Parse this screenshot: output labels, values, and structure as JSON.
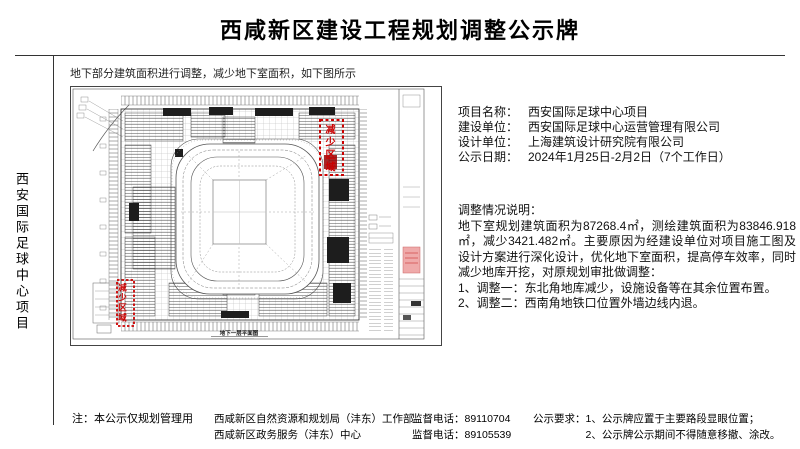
{
  "page": {
    "title": "西咸新区建设工程规划调整公示牌",
    "left_label": "西安国际足球中心项目",
    "drawing_note": "地下部分建筑面积进行调整，减少地下室面积，如下图所示"
  },
  "drawing": {
    "reduce_area_ne": "减少区域",
    "reduce_area_sw": "减少区域",
    "caption": "地下一层平面图"
  },
  "info": {
    "rows": [
      {
        "label": "项目名称：",
        "value": "西安国际足球中心项目"
      },
      {
        "label": "建设单位：",
        "value": "西安国际足球中心运营管理有限公司"
      },
      {
        "label": "设计单位：",
        "value": "上海建筑设计研究院有限公司"
      },
      {
        "label": "公示日期：",
        "value": "2024年1月25日-2月2日（7个工作日）"
      }
    ]
  },
  "adjustment": {
    "heading": "调整情况说明：",
    "body": "地下室规划建筑面积为87268.4㎡，测绘建筑面积为83846.918㎡，减少3421.482㎡。主要原因为经建设单位对项目施工图及设计方案进行深化设计，优化地下室面积，提高停车效率，同时减少地库开挖，对原规划审批做调整：",
    "items": [
      "1、调整一：东北角地库减少，设施设备等在其余位置布置。",
      "2、调整二：西南角地铁口位置外墙边线内退。"
    ]
  },
  "footer": {
    "note": "注：本公示仅规划管理用",
    "agencies": [
      {
        "name": "西咸新区自然资源和规划局（沣东）工作部",
        "phone_label": "监督电话：",
        "phone": "89110704"
      },
      {
        "name": "西咸新区政务服务（沣东）中心",
        "phone_label": "监督电话：",
        "phone": "89105539"
      }
    ],
    "requirements_label": "公示要求：",
    "requirements": [
      "1、公示牌应置于主要路段显眼位置；",
      "2、公示牌公示期间不得随意移撤、涂改。"
    ]
  },
  "colors": {
    "accent_red": "#cc0000",
    "stamp_pink": "#efaaaa"
  }
}
